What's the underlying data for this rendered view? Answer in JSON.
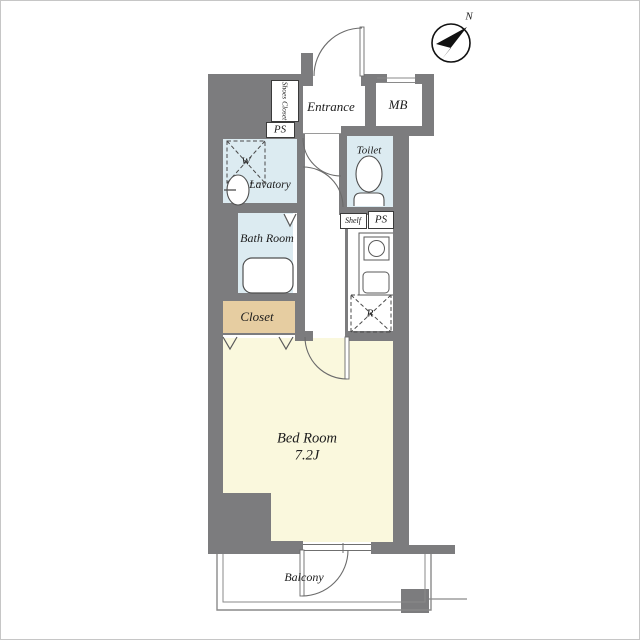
{
  "labels": {
    "shoes_closet": "Shoes Closet",
    "entrance": "Entrance",
    "meter_box": "MB",
    "pipe_space_top": "PS",
    "toilet": "Toilet",
    "washing_machine": "W",
    "lavatory": "Lavatory",
    "bath_room": "Bath Room",
    "shelf": "Shelf",
    "pipe_space_bottom": "PS",
    "refrigerator": "R",
    "closet": "Closet",
    "bed_room": "Bed Room",
    "bed_room_size": "7.2J",
    "balcony": "Balcony",
    "north": "N"
  },
  "colors": {
    "wall": "#7c7c7e",
    "wet_area": "#dcebf1",
    "closet": "#e6cda1",
    "bed_room": "#faf8dd",
    "outline": "#4f4f4f",
    "thin_line": "#8a8a8a"
  }
}
